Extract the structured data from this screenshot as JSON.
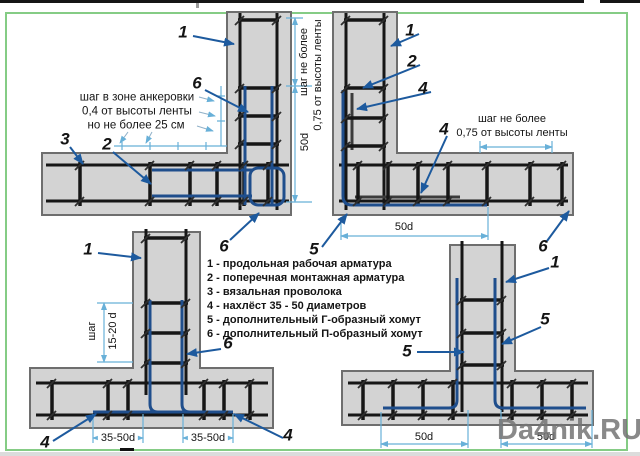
{
  "watermark": "Da4nik.RU",
  "callouts": {
    "n1": "1",
    "n2": "2",
    "n3": "3",
    "n4": "4",
    "n5": "5",
    "n6": "6"
  },
  "dims": {
    "d50": "50d",
    "d35_50": "35-50d",
    "d15_20": "15-20 d",
    "step": "шаг",
    "step_max_1": "шаг не более",
    "step_max_2": "0,75 от высоты ленты",
    "anchor_1": "шаг в зоне анкеровки",
    "anchor_2": "0,4 от высоты ленты",
    "anchor_3": "но не более 25 см"
  },
  "legend": {
    "items": [
      "1 - продольная рабочая арматура",
      "2 - поперечная монтажная арматура",
      "3 - вязальная проволока",
      "4 - нахлёст 35 - 50 диаметров",
      "5 - дополнительный Г-образный хомут",
      "6 - дополнительный П-образный хомут"
    ]
  },
  "colors": {
    "concrete": "#d3d3d3",
    "outline": "#6e6e6e",
    "rebar": "#161616",
    "clamp": "#1f4e8c",
    "arrow": "#1d5a9e",
    "dimension": "#68b0d8",
    "border-green": "#85cc85",
    "watermark-gray": "#757575"
  }
}
